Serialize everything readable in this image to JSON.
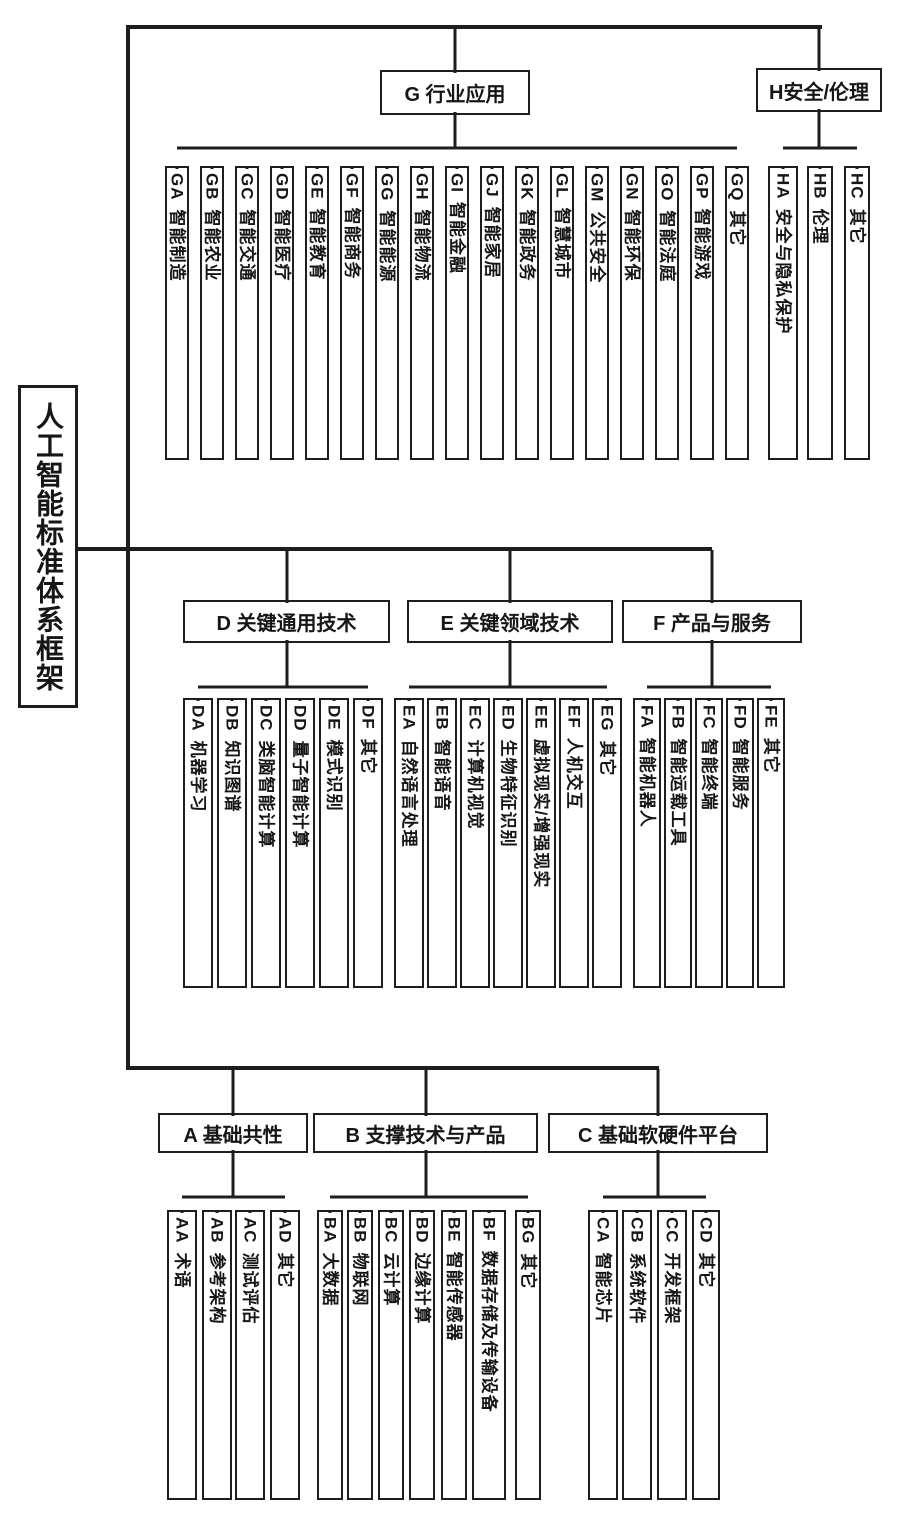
{
  "root": {
    "label": "人工智能标准体系框架"
  },
  "colors": {
    "line": "#1e1e1e",
    "background": "#ffffff"
  },
  "groups": [
    {
      "id": "G",
      "title": "G 行业应用",
      "children": [
        {
          "code": "GA",
          "label": "智能制造"
        },
        {
          "code": "GB",
          "label": "智能农业"
        },
        {
          "code": "GC",
          "label": "智能交通"
        },
        {
          "code": "GD",
          "label": "智能医疗"
        },
        {
          "code": "GE",
          "label": "智能教育"
        },
        {
          "code": "GF",
          "label": "智能商务"
        },
        {
          "code": "GG",
          "label": "智能能源"
        },
        {
          "code": "GH",
          "label": "智能物流"
        },
        {
          "code": "GI",
          "label": "智能金融"
        },
        {
          "code": "GJ",
          "label": "智能家居"
        },
        {
          "code": "GK",
          "label": "智能政务"
        },
        {
          "code": "GL",
          "label": "智慧城市"
        },
        {
          "code": "GM",
          "label": "公共安全"
        },
        {
          "code": "GN",
          "label": "智能环保"
        },
        {
          "code": "GO",
          "label": "智能法庭"
        },
        {
          "code": "GP",
          "label": "智能游戏"
        },
        {
          "code": "GQ",
          "label": "其它"
        }
      ]
    },
    {
      "id": "H",
      "title": "H安全/伦理",
      "children": [
        {
          "code": "HA",
          "label": "安全与隐私保护"
        },
        {
          "code": "HB",
          "label": "伦理"
        },
        {
          "code": "HC",
          "label": "其它"
        }
      ]
    },
    {
      "id": "D",
      "title": "D 关键通用技术",
      "children": [
        {
          "code": "DA",
          "label": "机器学习"
        },
        {
          "code": "DB",
          "label": "知识图谱"
        },
        {
          "code": "DC",
          "label": "类脑智能计算"
        },
        {
          "code": "DD",
          "label": "量子智能计算"
        },
        {
          "code": "DE",
          "label": "模式识别"
        },
        {
          "code": "DF",
          "label": "其它"
        }
      ]
    },
    {
      "id": "E",
      "title": "E 关键领域技术",
      "children": [
        {
          "code": "EA",
          "label": "自然语言处理"
        },
        {
          "code": "EB",
          "label": "智能语音"
        },
        {
          "code": "EC",
          "label": "计算机视觉"
        },
        {
          "code": "ED",
          "label": "生物特征识别"
        },
        {
          "code": "EE",
          "label": "虚拟现实/增强现实"
        },
        {
          "code": "EF",
          "label": "人机交互"
        },
        {
          "code": "EG",
          "label": "其它"
        }
      ]
    },
    {
      "id": "F",
      "title": "F 产品与服务",
      "children": [
        {
          "code": "FA",
          "label": "智能机器人"
        },
        {
          "code": "FB",
          "label": "智能运载工具"
        },
        {
          "code": "FC",
          "label": "智能终端"
        },
        {
          "code": "FD",
          "label": "智能服务"
        },
        {
          "code": "FE",
          "label": "其它"
        }
      ]
    },
    {
      "id": "A",
      "title": "A 基础共性",
      "children": [
        {
          "code": "AA",
          "label": "术语"
        },
        {
          "code": "AB",
          "label": "参考架构"
        },
        {
          "code": "AC",
          "label": "测试评估"
        },
        {
          "code": "AD",
          "label": "其它"
        }
      ]
    },
    {
      "id": "B",
      "title": "B 支撑技术与产品",
      "children": [
        {
          "code": "BA",
          "label": "大数据"
        },
        {
          "code": "BB",
          "label": "物联网"
        },
        {
          "code": "BC",
          "label": "云计算"
        },
        {
          "code": "BD",
          "label": "边缘计算"
        },
        {
          "code": "BE",
          "label": "智能传感器"
        },
        {
          "code": "BF",
          "label": "数据存储及传输设备"
        },
        {
          "code": "BG",
          "label": "其它"
        }
      ]
    },
    {
      "id": "C",
      "title": "C 基础软硬件平台",
      "children": [
        {
          "code": "CA",
          "label": "智能芯片"
        },
        {
          "code": "CB",
          "label": "系统软件"
        },
        {
          "code": "CC",
          "label": "开发框架"
        },
        {
          "code": "CD",
          "label": "其它"
        }
      ]
    }
  ]
}
